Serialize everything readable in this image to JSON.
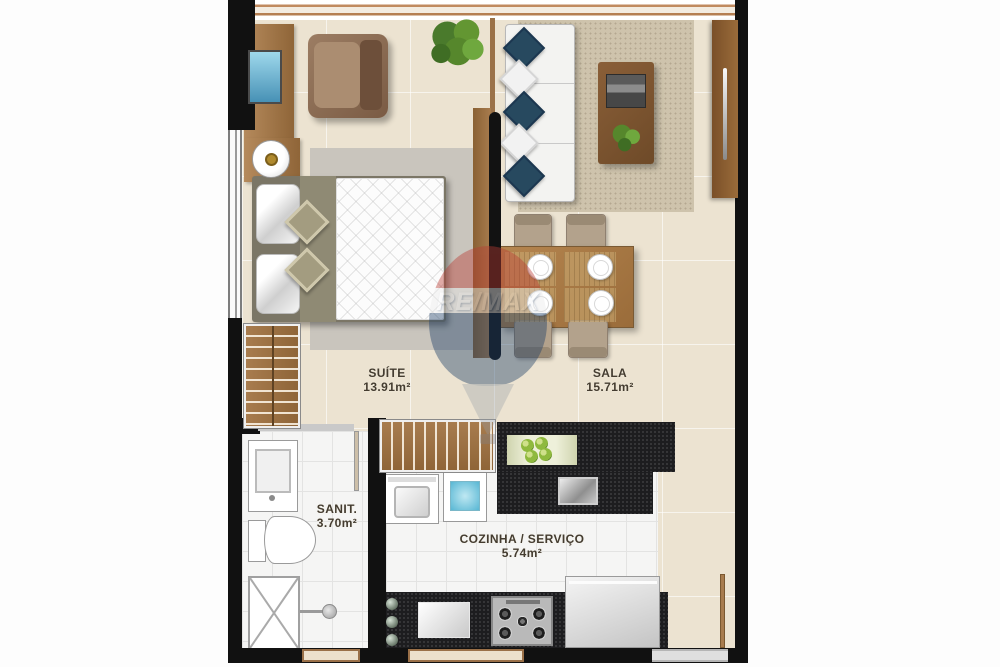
{
  "rooms": {
    "suite": {
      "name": "SUÍTE",
      "area": "13.91m²"
    },
    "sala": {
      "name": "SALA",
      "area": "15.71m²"
    },
    "sanit": {
      "name": "SANIT.",
      "area": "3.70m²"
    },
    "cozinha": {
      "name": "COZINHA / SERVIÇO",
      "area": "5.74m²"
    }
  },
  "watermark": {
    "brand": "RE/MAX"
  },
  "colors": {
    "wall_black": "#111111",
    "floor_beige": "#ece3d1",
    "floor_white": "#f5f5f4",
    "wood": "#a87c4e",
    "counter_granite": "#1d1d1f",
    "pillow_navy": "#27495f",
    "laundry_blue": "#58b7d4",
    "screen_blue": "#4791b5",
    "plant_green": "#5c8f38",
    "watermark_red": "#b93a32",
    "watermark_blue": "#1f4068"
  }
}
